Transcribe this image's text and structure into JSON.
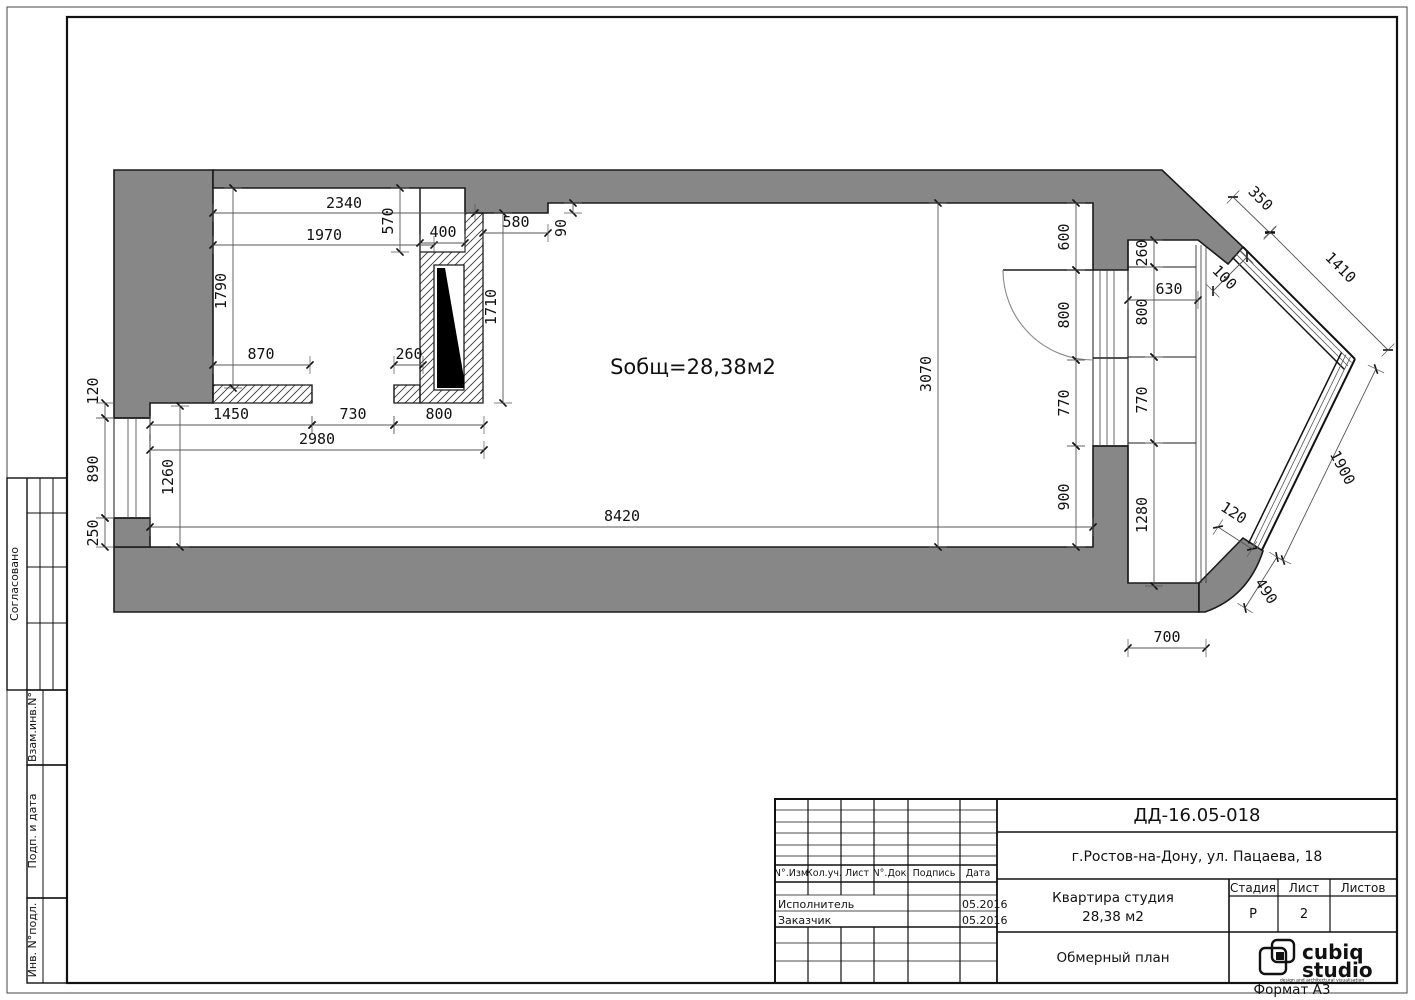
{
  "page": {
    "format_label": "Формат А3"
  },
  "colors": {
    "wall_fill": "#878787",
    "line": "#1a1a1a",
    "dim_line": "#555555"
  },
  "plan": {
    "area_label": "Sобщ=28,38м2",
    "dimensions": [
      [
        "2340",
        213,
        213,
        475,
        213,
        344,
        208,
        0
      ],
      [
        "1970",
        213,
        245,
        434,
        245,
        324,
        240,
        0
      ],
      [
        "570",
        400,
        188,
        400,
        252,
        393,
        221,
        -90
      ],
      [
        "400",
        420,
        243,
        465,
        243,
        443,
        237,
        0
      ],
      [
        "580",
        483,
        233,
        548,
        233,
        516,
        227,
        0
      ],
      [
        "90",
        573,
        203,
        573,
        213,
        566,
        228,
        -90
      ],
      [
        "1790",
        233,
        188,
        233,
        388,
        226,
        291,
        -90
      ],
      [
        "870",
        213,
        365,
        310,
        365,
        261,
        359,
        0
      ],
      [
        "260",
        394,
        365,
        423,
        365,
        409,
        359,
        0
      ],
      [
        "1710",
        503,
        213,
        503,
        403,
        496,
        307,
        -90
      ],
      [
        "1450",
        150,
        425,
        312,
        425,
        231,
        419,
        0
      ],
      [
        "730",
        312,
        425,
        394,
        425,
        353,
        419,
        0
      ],
      [
        "800",
        394,
        425,
        484,
        425,
        439,
        419,
        0
      ],
      [
        "2980",
        150,
        450,
        484,
        450,
        317,
        444,
        0
      ],
      [
        "120",
        105,
        403,
        105,
        418,
        98,
        391,
        -90
      ],
      [
        "890",
        105,
        418,
        105,
        518,
        98,
        469,
        -90
      ],
      [
        "250",
        105,
        518,
        105,
        547,
        98,
        533,
        -90
      ],
      [
        "1260",
        180,
        406,
        180,
        547,
        173,
        477,
        -90
      ],
      [
        "8420",
        150,
        527,
        1093,
        527,
        622,
        521,
        0
      ],
      [
        "3070",
        938,
        203,
        938,
        547,
        931,
        374,
        -90
      ],
      [
        "600",
        1076,
        203,
        1076,
        270,
        1069,
        237,
        -90
      ],
      [
        "800",
        1076,
        270,
        1076,
        360,
        1069,
        315,
        -90
      ],
      [
        "770",
        1076,
        360,
        1076,
        446,
        1069,
        403,
        -90
      ],
      [
        "900",
        1076,
        446,
        1076,
        547,
        1069,
        497,
        -90
      ],
      [
        "260",
        1154,
        240,
        1154,
        267,
        1147,
        253,
        -90
      ],
      [
        "630",
        1128,
        300,
        1198,
        300,
        1169,
        294,
        0
      ],
      [
        "800",
        1154,
        267,
        1154,
        357,
        1147,
        312,
        -90
      ],
      [
        "770",
        1154,
        357,
        1154,
        443,
        1147,
        400,
        -90
      ],
      [
        "1280",
        1154,
        443,
        1154,
        586,
        1147,
        515,
        -90
      ],
      [
        "700",
        1128,
        648,
        1206,
        648,
        1167,
        642,
        0
      ],
      [
        "350",
        1233,
        197,
        1270,
        233,
        1257,
        202,
        45
      ],
      [
        "1410",
        1270,
        232,
        1388,
        350,
        1337,
        271,
        45
      ],
      [
        "100",
        1213,
        291,
        1247,
        257,
        1221,
        281,
        45
      ],
      [
        "1900",
        1376,
        369,
        1283,
        560,
        1338,
        470,
        62
      ],
      [
        "120",
        1218,
        527,
        1252,
        549,
        1231,
        517,
        33
      ],
      [
        "490",
        1277,
        557,
        1245,
        608,
        1262,
        594,
        56
      ]
    ]
  },
  "left_strip": {
    "approved": "Согласовано",
    "vzam": "Взам.инв.N°",
    "podp": "Подп. и дата",
    "inv": "Инв. N°подл."
  },
  "titleblock": {
    "code": "ДД-16.05-018",
    "address": "г.Ростов-на-Дону,  ул. Пацаева, 18",
    "object_line1": "Квартира студия",
    "object_line2": "28,38 м2",
    "stage_label": "Стадия",
    "sheet_label": "Лист",
    "sheets_label": "Листов",
    "stage_value": "Р",
    "sheet_value": "2",
    "sheets_value": "",
    "drawing_name": "Обмерный план",
    "logo_line1": "cubiq",
    "logo_line2": "studio",
    "logo_tagline": "design and architectural visualisation",
    "rev_headers": [
      "N°.Изм",
      "Кол.уч.",
      "Лист",
      "N°.Док.",
      "Подпись",
      "Дата"
    ],
    "rows": [
      {
        "role": "Исполнитель",
        "date": "05.2016"
      },
      {
        "role": "Заказчик",
        "date": "05.2016"
      }
    ]
  }
}
